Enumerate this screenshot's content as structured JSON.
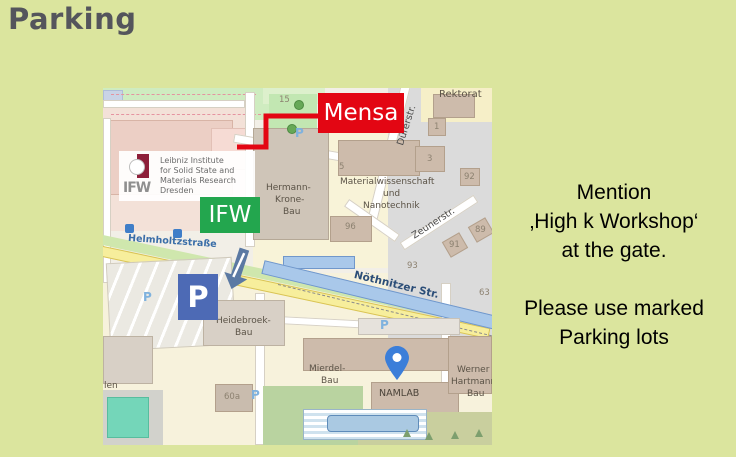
{
  "slide": {
    "title": "Parking"
  },
  "note": {
    "p1": [
      "Mention",
      "‚High k Workshop‘",
      "at the gate."
    ],
    "p2": [
      "Please use marked",
      "Parking lots"
    ]
  },
  "map": {
    "callouts": {
      "mensa": "Mensa",
      "ifw": "IFW",
      "parking": "P"
    },
    "logo": {
      "abbr": "IFW",
      "lines": [
        "Leibniz Institute",
        "for Solid State and",
        "Materials Research",
        "Dresden"
      ]
    },
    "streets": {
      "helmholtz": "Helmholtzstraße",
      "noethnitzer": "Nöthnitzer Str.",
      "duerer": "Dürerstr.",
      "zeuner": "Zeunerstr."
    },
    "buildings": {
      "hermann": [
        "Hermann-",
        "Krone-",
        "Bau"
      ],
      "material": [
        "Materialwissenschaft",
        "und",
        "Nanotechnik"
      ],
      "heidebroek": [
        "Heidebroek-",
        "Bau"
      ],
      "mierdel": [
        "Mierdel-",
        "Bau"
      ],
      "namlab": "NAMLAB",
      "werner": [
        "Werner",
        "Hartmann",
        "Bau"
      ],
      "rektorat": "Rektorat"
    },
    "numbers": {
      "n15": "15",
      "n1": "1",
      "n3": "3",
      "n5": "5",
      "n92": "92",
      "n96": "96",
      "n93": "93",
      "n91": "91",
      "n89": "89",
      "n63": "63",
      "n60a": "60a",
      "len": "len"
    },
    "p_icon": "P"
  },
  "colors": {
    "slide_bg": "#dbe59e",
    "title": "#54555c",
    "mensa_red": "#e30613",
    "ifw_green": "#23a64e",
    "parking_blue": "#4d6ab5",
    "arrow_blue": "#5b79a3",
    "pin_blue": "#3b7ed9",
    "street_highlight": "#a9c8ea"
  }
}
